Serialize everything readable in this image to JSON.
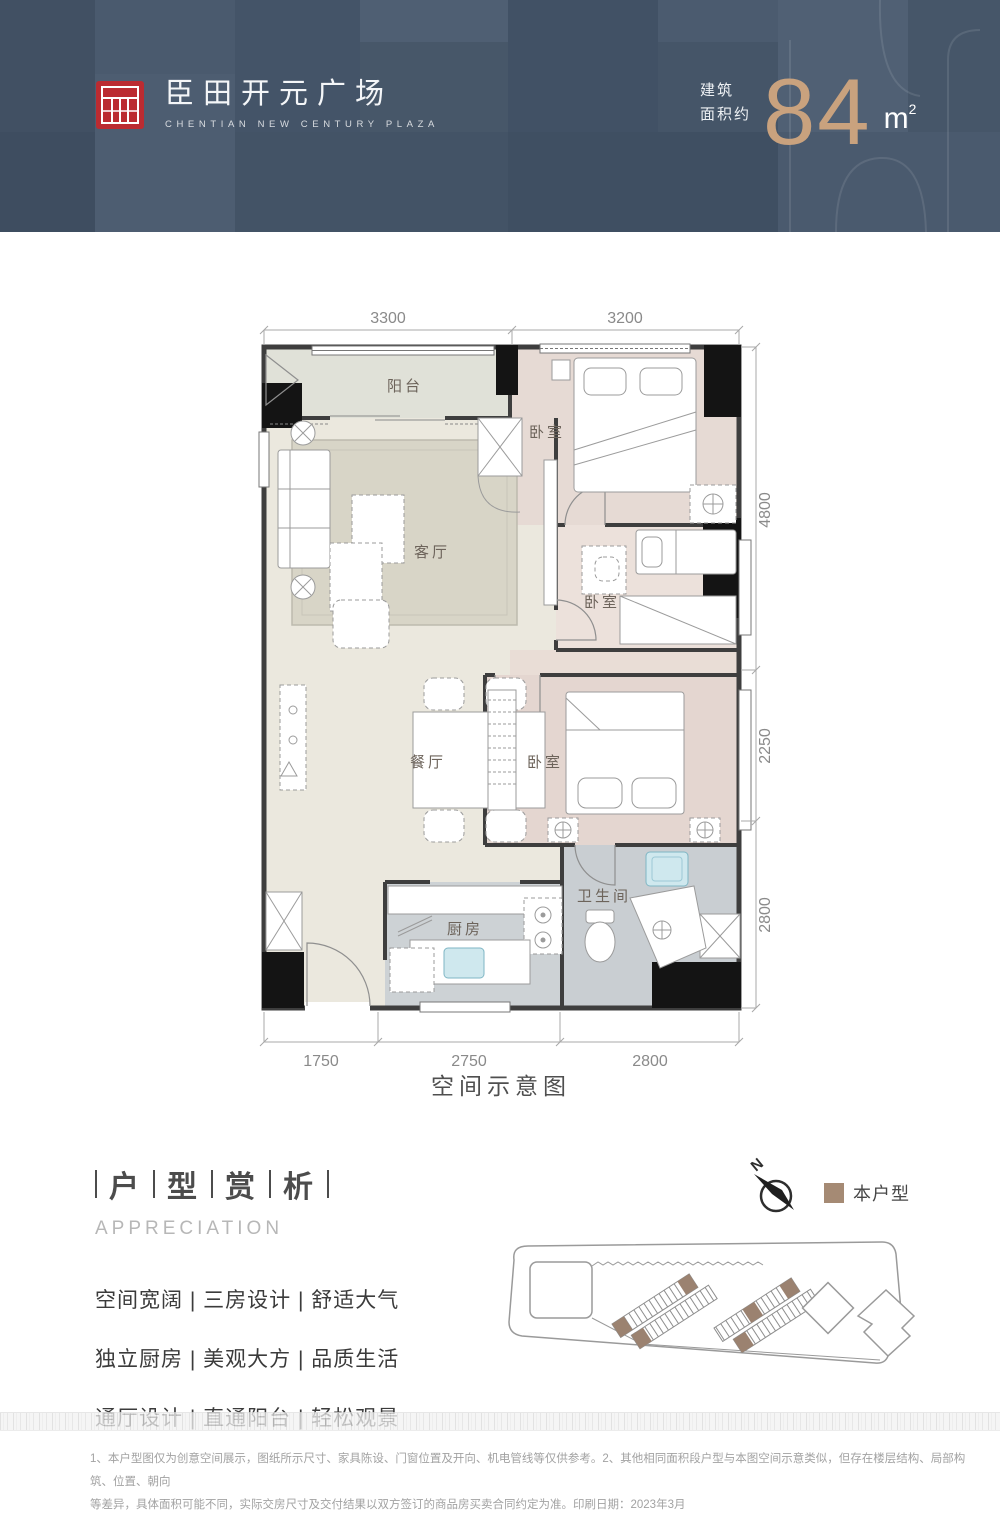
{
  "header": {
    "brand": {
      "name": "臣田开元广场",
      "name_en": "CHENTIAN NEW CENTURY PLAZA",
      "seal_color": "#bb2b31"
    },
    "area": {
      "label_line1": "建筑",
      "label_line2": "面积约",
      "value": "84",
      "unit": "m",
      "unit_sup": "2",
      "accent_color": "#c9a27e"
    },
    "bg_color": "#46566a"
  },
  "floorplan": {
    "caption": "空间示意图",
    "rooms": [
      {
        "name": "balcony",
        "label": "阳台"
      },
      {
        "name": "living-room",
        "label": "客厅"
      },
      {
        "name": "master-bedroom",
        "label": "卧室"
      },
      {
        "name": "bedroom-2",
        "label": "卧室"
      },
      {
        "name": "bedroom-3",
        "label": "卧室"
      },
      {
        "name": "dining-room",
        "label": "餐厅"
      },
      {
        "name": "kitchen",
        "label": "厨房"
      },
      {
        "name": "bathroom",
        "label": "卫生间"
      }
    ],
    "dimensions": {
      "top": [
        "3300",
        "3200"
      ],
      "right": [
        "4800",
        "2250",
        "2800"
      ],
      "bottom": [
        "1750",
        "2750",
        "2800"
      ]
    }
  },
  "appreciation": {
    "title_chars": [
      "户",
      "型",
      "赏",
      "析"
    ],
    "subtitle": "APPRECIATION",
    "features": [
      "空间宽阔 | 三房设计 | 舒适大气",
      "独立厨房 | 美观大方 | 品质生活",
      "通厅设计 | 直通阳台 | 轻松观景"
    ]
  },
  "legend": {
    "compass_label": "N",
    "this_unit_label": "本户型",
    "this_unit_color": "#a58a74"
  },
  "footer": {
    "disclaimer_line1": "1、本户型图仅为创意空间展示，图纸所示尺寸、家具陈设、门窗位置及开向、机电管线等仅供参考。2、其他相同面积段户型与本图空间示意类似，但存在楼层结构、局部构筑、位置、朝向",
    "disclaimer_line2": "等差异，具体面积可能不同，实际交房尺寸及交付结果以双方签订的商品房买卖合同约定为准。印刷日期：2023年3月"
  }
}
